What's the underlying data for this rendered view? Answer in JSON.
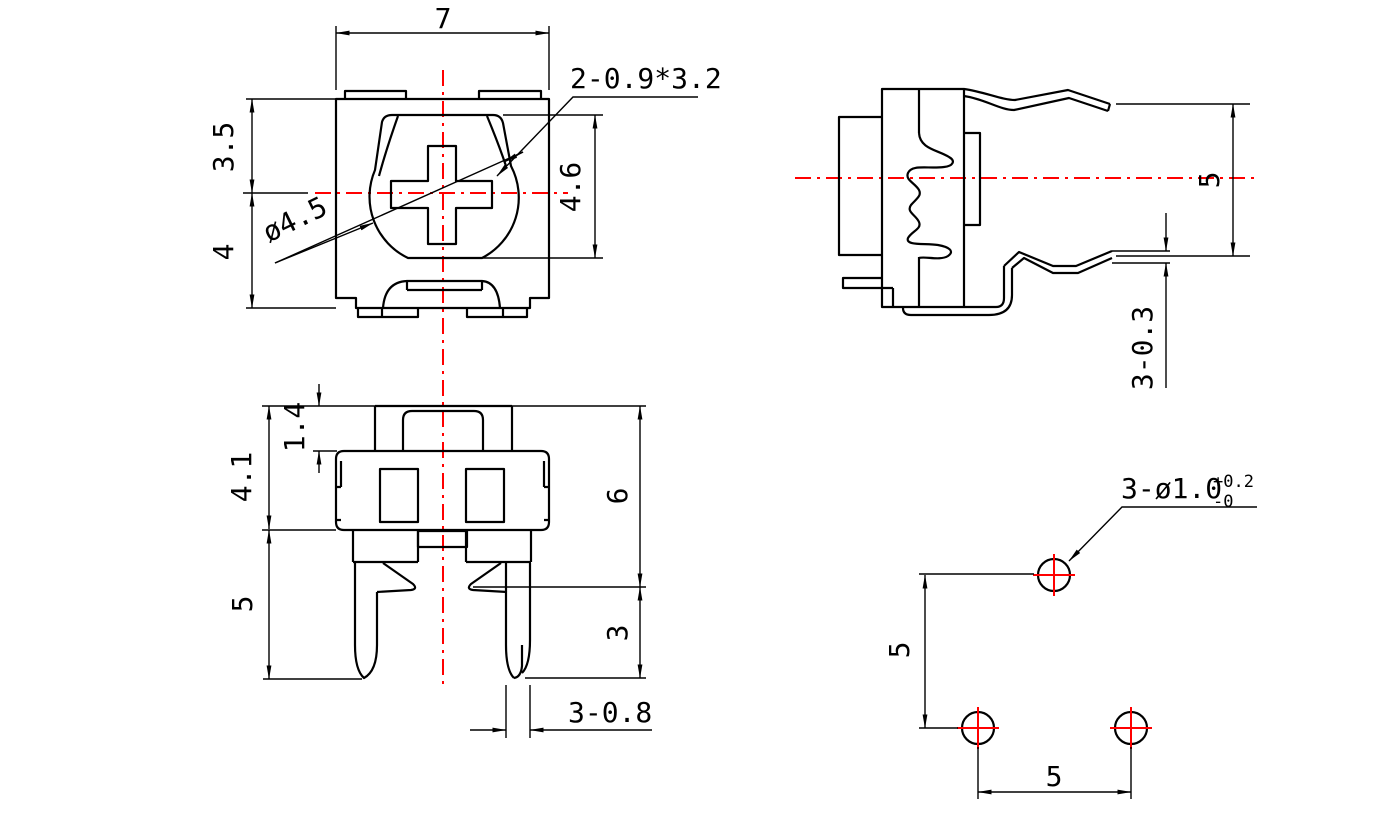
{
  "colors": {
    "line": "#000000",
    "centerline": "#ff0000",
    "background": "#ffffff"
  },
  "views": {
    "top_view": {
      "dims": {
        "overall_width": "7",
        "upper_height": "3.5",
        "lower_height": "4",
        "rotor_height": "4.6",
        "rotor_diameter": "ø4.5",
        "cross_slot": "2-0.9*3.2"
      }
    },
    "side_view": {
      "dims": {
        "pin_span": "5",
        "pin_thickness": "3-0.3"
      }
    },
    "front_view": {
      "dims": {
        "cap_height": "1.4",
        "upper_body_height": "4.1",
        "leg_length": "5",
        "body_height": "6",
        "leg_exposed": "3",
        "leg_width": "3-0.8"
      }
    },
    "footprint_view": {
      "dims": {
        "row_pitch": "5",
        "col_pitch": "5"
      },
      "hole_callout": {
        "label": "3-ø1.0",
        "tol_plus": "+0.2",
        "tol_minus": "-0"
      }
    }
  }
}
